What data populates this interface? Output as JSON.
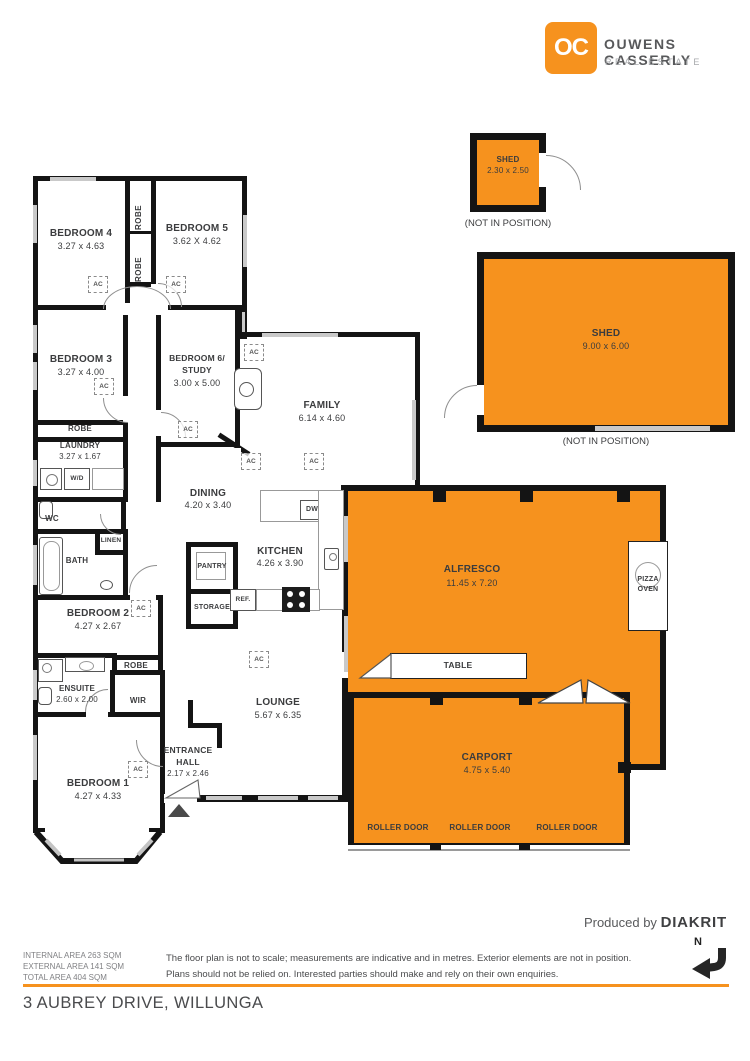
{
  "brand": {
    "logo": "OC",
    "name": "OUWENS CASSERLY",
    "tagline": "REAL ESTATE"
  },
  "sheds": {
    "small": {
      "label": "SHED",
      "dims": "2.30 x 2.50",
      "note": "(NOT IN POSITION)"
    },
    "large": {
      "label": "SHED",
      "dims": "9.00 x 6.00",
      "note": "(NOT IN POSITION)"
    }
  },
  "rooms": {
    "bedroom4": {
      "label": "BEDROOM 4",
      "dims": "3.27 x 4.63"
    },
    "bedroom5": {
      "label": "BEDROOM 5",
      "dims": "3.62 X 4.62"
    },
    "bedroom3": {
      "label": "BEDROOM 3",
      "dims": "3.27 x 4.00"
    },
    "bedroom6": {
      "label": "BEDROOM 6/",
      "label2": "STUDY",
      "dims": "3.00 x 5.00"
    },
    "family": {
      "label": "FAMILY",
      "dims": "6.14 x 4.60"
    },
    "dining": {
      "label": "DINING",
      "dims": "4.20 x 3.40"
    },
    "kitchen": {
      "label": "KITCHEN",
      "dims": "4.26 x 3.90"
    },
    "laundry": {
      "label": "LAUNDRY",
      "dims": "3.27 x 1.67"
    },
    "bedroom2": {
      "label": "BEDROOM 2",
      "dims": "4.27 x 2.67"
    },
    "ensuite": {
      "label": "ENSUITE",
      "dims": "2.60 x 2.00"
    },
    "bedroom1": {
      "label": "BEDROOM 1",
      "dims": "4.27 x 4.33"
    },
    "lounge": {
      "label": "LOUNGE",
      "dims": "5.67 x 6.35"
    },
    "entrance": {
      "label": "ENTRANCE",
      "label2": "HALL",
      "dims": "2.17 x 2.46"
    },
    "alfresco": {
      "label": "ALFRESCO",
      "dims": "11.45 x 7.20"
    },
    "carport": {
      "label": "CARPORT",
      "dims": "4.75 x 5.40"
    }
  },
  "labels": {
    "ac": "AC",
    "robe": "ROBE",
    "wc": "WC",
    "bath": "BATH",
    "linen": "LINEN",
    "wir": "WIR",
    "pantry": "PANTRY",
    "storage": "STORAGE",
    "ref": "REF.",
    "wd": "W/D",
    "dw": "DW",
    "table": "TABLE",
    "pizza1": "PIZZA",
    "pizza2": "OVEN",
    "roller_door": "ROLLER DOOR"
  },
  "footer": {
    "areas": {
      "line1": "INTERNAL AREA 263 SQM",
      "line2": "EXTERNAL AREA 141 SQM",
      "line3": "TOTAL AREA 404 SQM"
    },
    "disclaimer": {
      "line1": "The floor plan is not to scale; measurements are indicative and in metres. Exterior elements are not in position.",
      "line2": "Plans should not be relied on. Interested parties should make and rely on their own enquiries."
    },
    "produced_by": "Produced by",
    "producer": "DIAKRIT",
    "address": "3 AUBREY DRIVE, WILLUNGA",
    "north": "N"
  },
  "colors": {
    "accent": "#F6921E",
    "wall": "#141414"
  }
}
